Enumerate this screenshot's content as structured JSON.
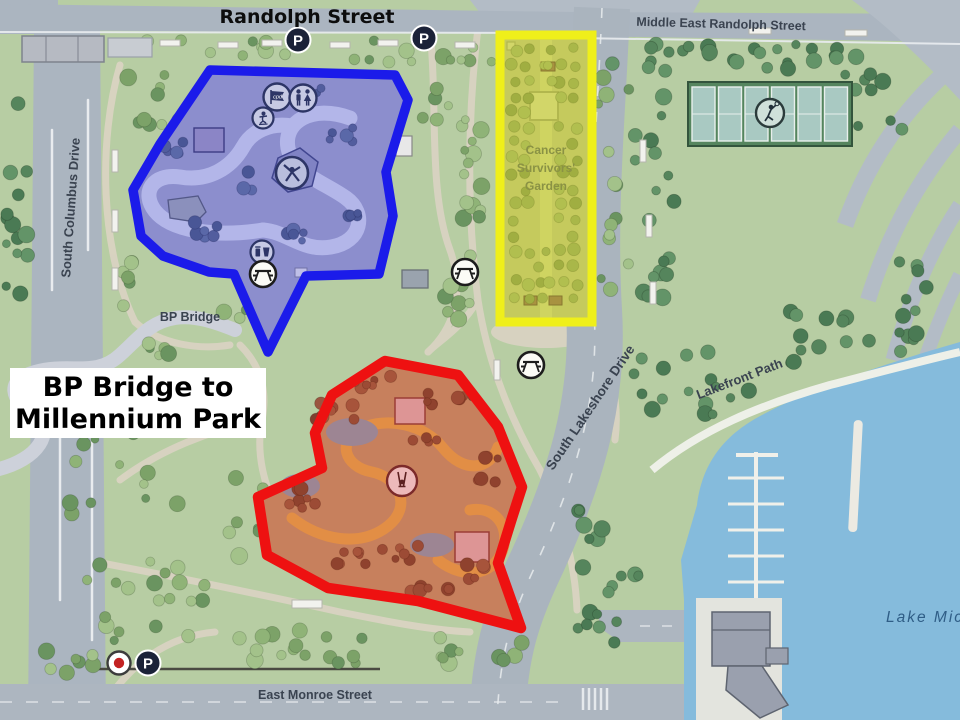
{
  "map": {
    "streets": {
      "randolph": "Randolph Street",
      "middle_east_randolph": "Middle East Randolph Street",
      "south_columbus": "South Columbus Drive",
      "south_lakeshore": "South Lakeshore Drive",
      "lakefront_path": "Lakefront Path",
      "east_monroe": "East Monroe Street"
    },
    "labels": {
      "bp_bridge": "BP Bridge",
      "lake": "Lake Mich",
      "garden_line1": "Cancer",
      "garden_line2": "Survivors'",
      "garden_line3": "Garden"
    },
    "annotation": {
      "line1": "BP Bridge to",
      "line2": "Millennium Park"
    },
    "icons": {
      "parking_letter": "P",
      "cpd_label": "cpd"
    },
    "colors": {
      "highlight_blue": "#1b1bea",
      "highlight_red": "#ee1111",
      "highlight_yellow": "#efef1a",
      "water": "#85bbdc",
      "park_green": "#b7cda3",
      "road_gray": "#abb5c0"
    }
  }
}
